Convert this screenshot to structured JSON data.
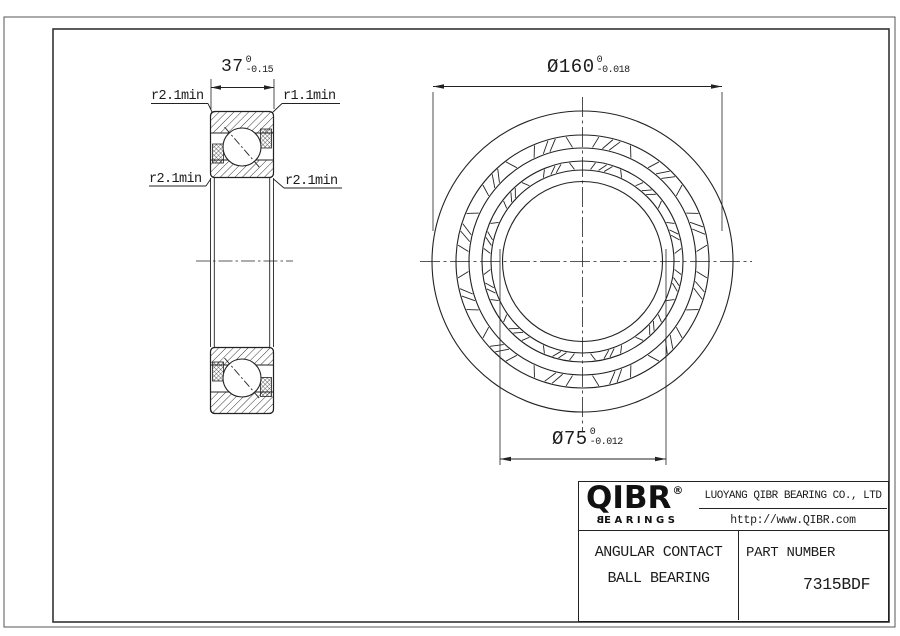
{
  "drawing": {
    "section_view": {
      "dim_width": {
        "value": "37",
        "tol_upper": "0",
        "tol_lower": "-0.15"
      },
      "labels": {
        "top_left": "r2.1min",
        "top_right": "r1.1min",
        "mid_left": "r2.1min",
        "mid_right": "r2.1min"
      }
    },
    "front_view": {
      "dim_outer": {
        "value": "Ø160",
        "tol_upper": "0",
        "tol_lower": "-0.018"
      },
      "dim_bore": {
        "value": "Ø75",
        "tol_upper": "0",
        "tol_lower": "-0.012"
      },
      "geometry": {
        "cx": 582.5,
        "cy": 261.5,
        "radii": [
          150.5,
          126.5,
          113.5,
          100.5,
          91.5,
          80
        ],
        "pocket_count": 12,
        "bands": [
          {
            "r_inner": 113.5,
            "r_outer": 126.5
          },
          {
            "r_inner": 91.5,
            "r_outer": 100.5
          }
        ]
      }
    },
    "line_color": "#222222"
  },
  "title_block": {
    "logo": {
      "name": "QIBR",
      "registered": "®",
      "sub_first": "B",
      "sub_rest": "EARINGS"
    },
    "company": "LUOYANG QIBR BEARING CO., LTD",
    "website": "http://www.QIBR.com",
    "product_line1": "ANGULAR CONTACT",
    "product_line2": "BALL BEARING",
    "part_number_label": "PART NUMBER",
    "part_number": "7315BDF"
  }
}
